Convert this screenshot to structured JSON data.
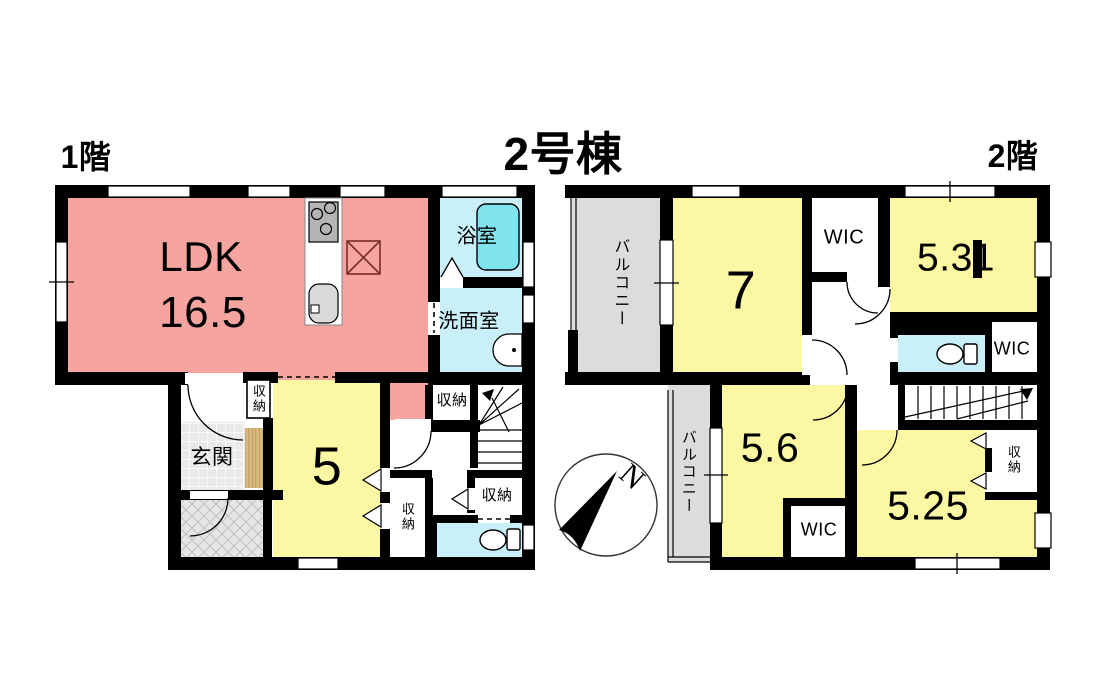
{
  "title": "2号棟",
  "colors": {
    "wall": "#000000",
    "ldk_pink": "#F5A4A0",
    "room_yellow": "#FBF7A2",
    "wet_cyan": "#C9F0F8",
    "tub_cyan": "#7FE4EE",
    "balcony_gray": "#DCDCDC",
    "tile_gray": "#E9E9E9",
    "porch_gray": "#E6E6E6",
    "wood_tan": "#D9B87E",
    "kitchen_x": "#7B2B2B"
  },
  "floor1": {
    "label": "1階",
    "ldk_name": "LDK",
    "ldk_area": "16.5",
    "bath": "浴室",
    "washroom": "洗面室",
    "entrance": "玄関",
    "room5": "5",
    "closet_entrance": "収納",
    "closet_hall": "収納",
    "closet_side": "収納",
    "closet_lower": "収納"
  },
  "floor2": {
    "label": "2階",
    "balcony_top": "バルコニー",
    "balcony_bottom": "バルコニー",
    "room7": "7",
    "room531": "5.31",
    "room56": "5.6",
    "room525": "5.25",
    "wic_top": "WIC",
    "wic_mid": "WIC",
    "wic_bottom": "WIC",
    "closet": "収納"
  },
  "compass": {
    "north": "N"
  }
}
